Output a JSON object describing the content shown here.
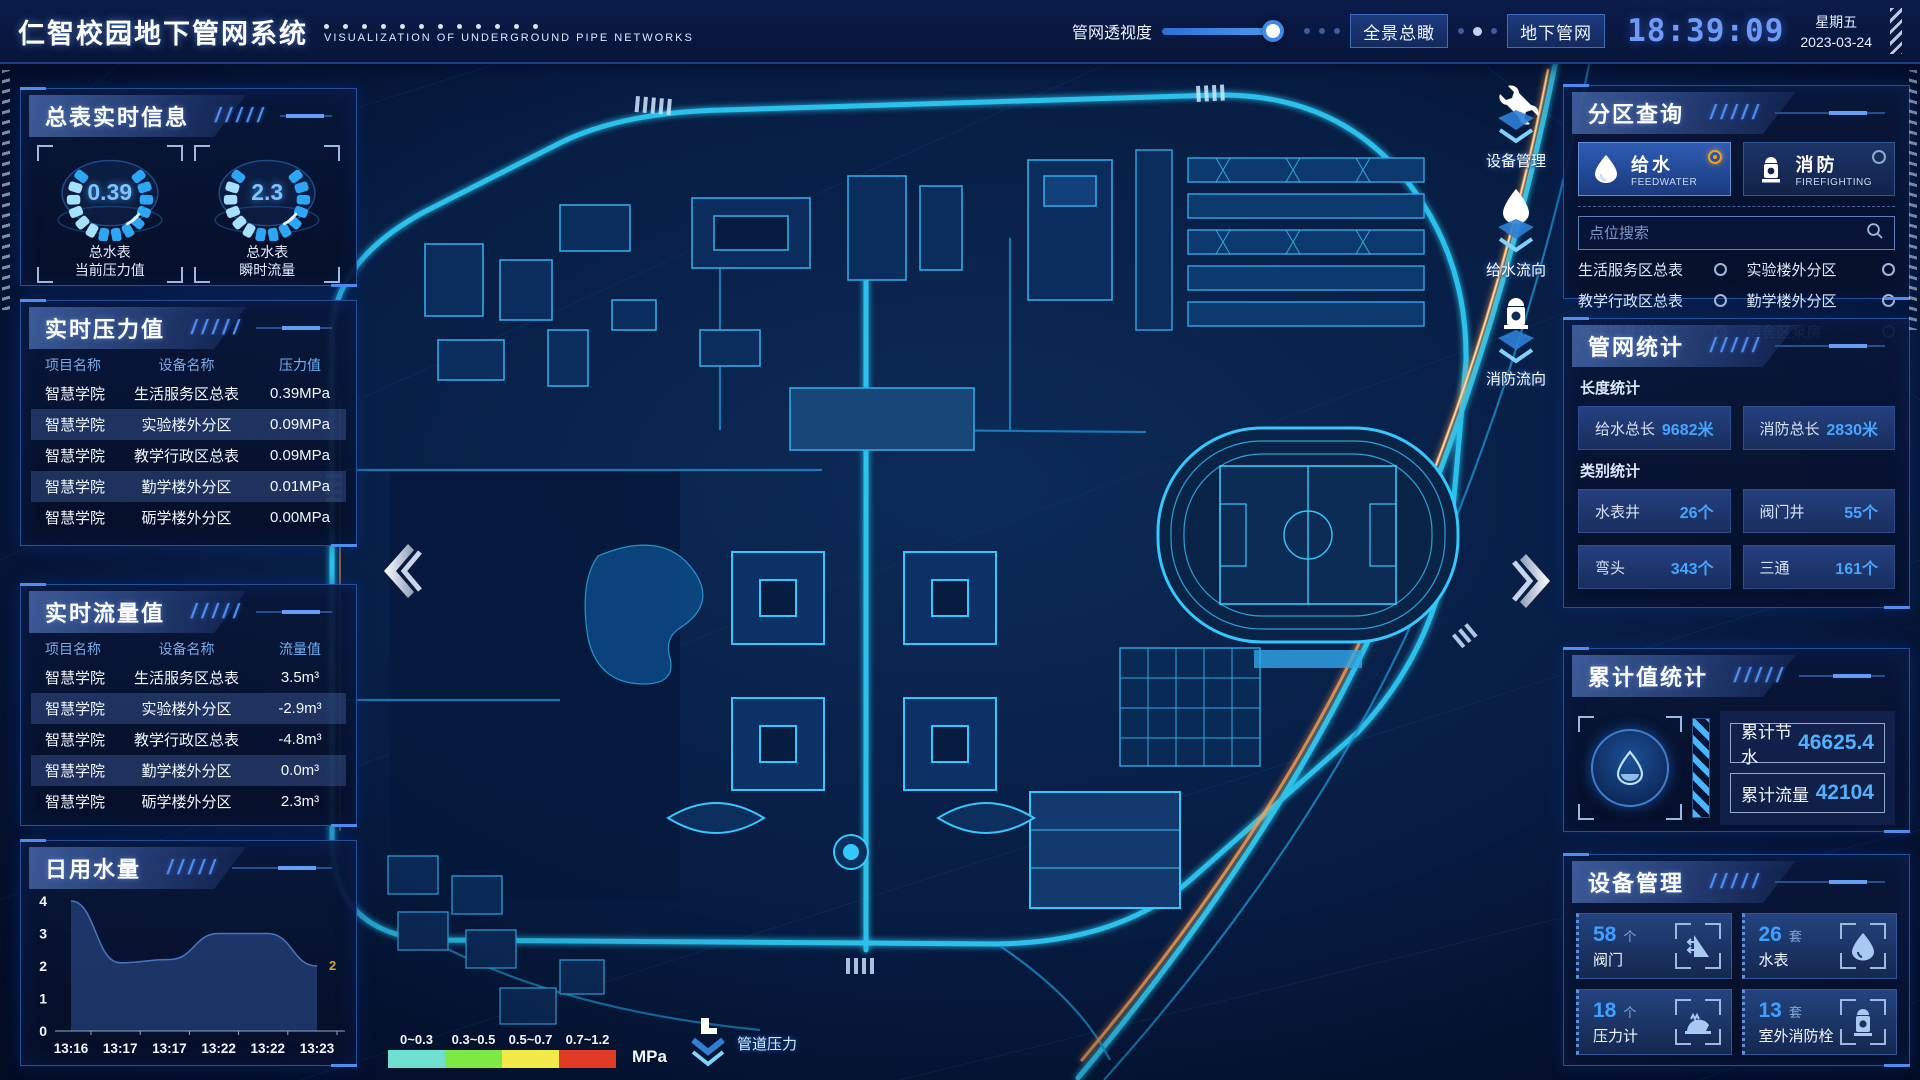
{
  "header": {
    "title": "仁智校园地下管网系统",
    "subtitle": "VISUALIZATION OF UNDERGROUND PIPE NETWORKS",
    "slider_label": "管网透视度",
    "buttons": [
      {
        "label": "全景总瞰"
      },
      {
        "label": "地下管网"
      }
    ],
    "time": "18:39:09",
    "weekday": "星期五",
    "date": "2023-03-24"
  },
  "left": {
    "meter_panel": {
      "title": "总表实时信息",
      "gauges": [
        {
          "value": "0.39",
          "label": "总水表\n当前压力值"
        },
        {
          "value": "2.3",
          "label": "总水表\n瞬时流量"
        }
      ]
    },
    "pressure_panel": {
      "title": "实时压力值",
      "headers": [
        "项目名称",
        "设备名称",
        "压力值"
      ],
      "rows": [
        {
          "project": "智慧学院",
          "device": "生活服务区总表",
          "value": "0.39MPa"
        },
        {
          "project": "智慧学院",
          "device": "实验楼外分区",
          "value": "0.09MPa"
        },
        {
          "project": "智慧学院",
          "device": "教学行政区总表",
          "value": "0.09MPa"
        },
        {
          "project": "智慧学院",
          "device": "勤学楼外分区",
          "value": "0.01MPa"
        },
        {
          "project": "智慧学院",
          "device": "砺学楼外分区",
          "value": "0.00MPa"
        }
      ]
    },
    "flow_panel": {
      "title": "实时流量值",
      "headers": [
        "项目名称",
        "设备名称",
        "流量值"
      ],
      "rows": [
        {
          "project": "智慧学院",
          "device": "生活服务区总表",
          "value": "3.5m³"
        },
        {
          "project": "智慧学院",
          "device": "实验楼外分区",
          "value": "-2.9m³"
        },
        {
          "project": "智慧学院",
          "device": "教学行政区总表",
          "value": "-4.8m³"
        },
        {
          "project": "智慧学院",
          "device": "勤学楼外分区",
          "value": "0.0m³"
        },
        {
          "project": "智慧学院",
          "device": "砺学楼外分区",
          "value": "2.3m³"
        }
      ]
    },
    "daily_panel": {
      "title": "日用水量"
    }
  },
  "chart_data": {
    "type": "area",
    "title": "日用水量",
    "x": [
      "13:16",
      "13:17",
      "13:17",
      "13:22",
      "13:22",
      "13:23"
    ],
    "values": [
      4,
      2.1,
      2.2,
      3,
      3,
      2
    ],
    "ylim": [
      0,
      4
    ],
    "yticks": [
      0,
      1,
      2,
      3,
      4
    ],
    "end_label": "2",
    "grid": false,
    "legend": "none"
  },
  "right": {
    "zone_panel": {
      "title": "分区查询",
      "tabs": [
        {
          "label": "给水",
          "sub": "FEEDWATER",
          "selected": true
        },
        {
          "label": "消防",
          "sub": "FIREFIGHTING",
          "selected": false
        }
      ],
      "search_placeholder": "点位搜索",
      "items": [
        "生活服务区总表",
        "实验楼外分区",
        "教学行政区总表",
        "勤学楼外分区",
        "砺学楼外分区",
        "宿舍区泵房"
      ]
    },
    "stats_panel": {
      "title": "管网统计",
      "length_label": "长度统计",
      "length_stats": [
        {
          "label": "给水总长",
          "value": "9682米"
        },
        {
          "label": "消防总长",
          "value": "2830米"
        }
      ],
      "category_label": "类别统计",
      "category_stats": [
        {
          "label": "水表井",
          "value": "26个"
        },
        {
          "label": "阀门井",
          "value": "55个"
        },
        {
          "label": "弯头",
          "value": "343个"
        },
        {
          "label": "三通",
          "value": "161个"
        }
      ]
    },
    "cumulative_panel": {
      "title": "累计值统计",
      "stats": [
        {
          "label": "累计节水",
          "value": "46625.4"
        },
        {
          "label": "累计流量",
          "value": "42104"
        }
      ]
    },
    "device_panel": {
      "title": "设备管理",
      "cards": [
        {
          "count": "58",
          "unit": "个",
          "name": "阀门",
          "icon": "valve-icon"
        },
        {
          "count": "26",
          "unit": "套",
          "name": "水表",
          "icon": "water-meter-icon"
        },
        {
          "count": "18",
          "unit": "个",
          "name": "压力计",
          "icon": "pressure-gauge-icon"
        },
        {
          "count": "13",
          "unit": "套",
          "name": "室外消防栓",
          "icon": "hydrant-icon"
        }
      ]
    }
  },
  "map": {
    "overlay_buttons": [
      {
        "label": "设备管理",
        "icon": "wrench-icon"
      },
      {
        "label": "给水流向",
        "icon": "water-drop-icon"
      },
      {
        "label": "消防流向",
        "icon": "hydrant-icon"
      }
    ],
    "legend": {
      "ranges": [
        {
          "label": "0~0.3",
          "color": "#6fe0d0"
        },
        {
          "label": "0.3~0.5",
          "color": "#7ce945"
        },
        {
          "label": "0.5~0.7",
          "color": "#f1ea47"
        },
        {
          "label": "0.7~1.2",
          "color": "#e23b25"
        }
      ],
      "unit": "MPa",
      "pipe_label": "管道压力"
    }
  },
  "colors": {
    "accent_cyan": "#2fd4ff",
    "accent_blue": "#3f87e8",
    "panel_border": "#27509b",
    "value_blue": "#46a6ff",
    "selected_radio_orange": "#f0a21c",
    "chart_end_label": "#d9a52c"
  }
}
